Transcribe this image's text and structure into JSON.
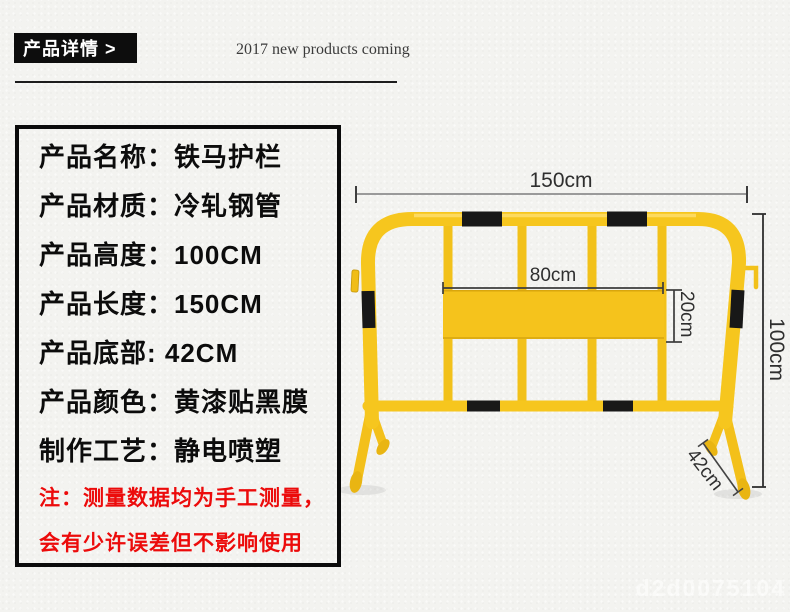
{
  "page": {
    "background": "#f3f3f0",
    "watermark": "d2d0075104"
  },
  "header": {
    "badge_label": "产品详情 >",
    "tagline": "2017 new products coming"
  },
  "spec_box": {
    "text_color": "#0c0c0c",
    "note_color": "#ec0b0b",
    "rows": [
      {
        "text": "产品名称：铁马护栏"
      },
      {
        "text": "产品材质：冷轧钢管"
      },
      {
        "text": "产品高度：100CM"
      },
      {
        "text": "产品长度：150CM"
      },
      {
        "text": "产品底部: 42CM"
      },
      {
        "text": "产品颜色：黄漆贴黑膜"
      },
      {
        "text": "制作工艺：静电喷塑"
      }
    ],
    "notes": [
      {
        "text": "注：测量数据均为手工测量，"
      },
      {
        "text": "会有少许误差但不影响使用"
      }
    ]
  },
  "diagram": {
    "product": "yellow-black iron horse barrier",
    "colors": {
      "tube_yellow": "#f6c61e",
      "panel_yellow": "#f5c31c",
      "band_black": "#181818",
      "dim_line": "#3c3c3c"
    },
    "dimensions": {
      "width_label": "150cm",
      "panel_width_label": "80cm",
      "panel_height_label": "20cm",
      "height_label": "100cm",
      "foot_label": "42cm"
    }
  }
}
